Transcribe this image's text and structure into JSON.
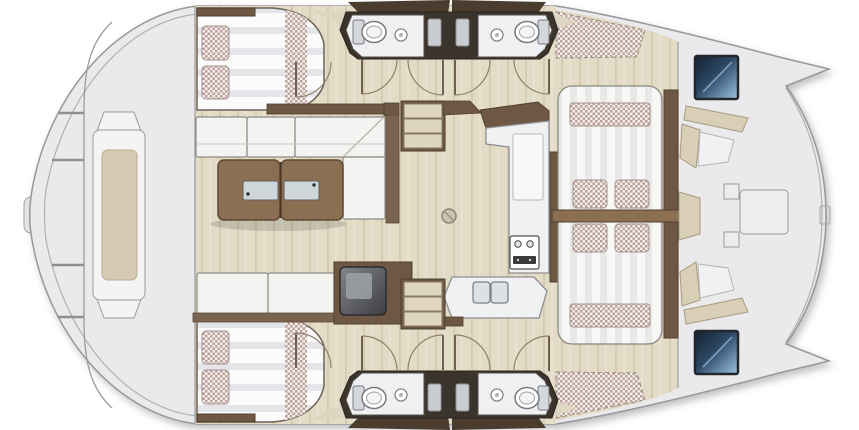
{
  "meta": {
    "title": "Catamaran deck and interior floor plan (top view)",
    "type": "boat-floor-plan",
    "orientation": "hulls top and bottom, lounge deck right, trampoline bow left"
  },
  "colors": {
    "canvas": "#ffffff",
    "hull": "#eaeaec",
    "hull_stroke": "#98989a",
    "floor_wood": "#e2dbc6",
    "cabinet_wood": "#6e5844",
    "table_wood": "#8a6f52",
    "joinery_dark": "#3b342c",
    "roof_wedge": "#4a3d30",
    "cushion_white": "#f3f3f1",
    "cushion_beige": "#d6cbb2",
    "deck_cushion": "#d9cfb6",
    "counter": "#f0f1f3",
    "metal": "#cfd6da",
    "appliance_frame": "#2c2c2e",
    "hatch_frame": "#23262b",
    "hatch_navy": "#2c4764",
    "mesh_accent": "#b2938f",
    "tray": "#c9ccd0"
  },
  "areas": [
    {
      "id": "bow-deck",
      "items": [
        "center-lounge-pod",
        "beige-cushion",
        "crossbars",
        "bow-step"
      ]
    },
    {
      "id": "upper-cabin",
      "items": [
        "double-berth",
        "two-checkered-pillows",
        "checkered-runner",
        "headboard-shelf"
      ]
    },
    {
      "id": "lower-cabin",
      "items": [
        "double-berth",
        "two-checkered-pillows",
        "checkered-runner",
        "headboard-shelf"
      ]
    },
    {
      "id": "upper-head",
      "items": [
        "toilet",
        "round-washbasin",
        "shower-column",
        "two-doors"
      ]
    },
    {
      "id": "lower-head",
      "items": [
        "toilet",
        "round-washbasin",
        "shower-column",
        "two-doors"
      ]
    },
    {
      "id": "salon",
      "items": [
        "l-shaped-sofa",
        "split-coffee-table",
        "bench-seat",
        "refrigerator-box"
      ]
    },
    {
      "id": "galley",
      "items": [
        "l-counter",
        "double-sink",
        "stove-panel",
        "round-floor-hatch"
      ]
    },
    {
      "id": "companionway",
      "items": [
        "upper-stairs-3-steps",
        "lower-stairs-3-steps"
      ]
    },
    {
      "id": "aft-lounge",
      "items": [
        "striped-sunpad",
        "four-checkered-pillows",
        "two-checkered-bolsters",
        "lounge-table-bar",
        "side-planks"
      ]
    },
    {
      "id": "stern-deck",
      "items": [
        "two-navy-hatches",
        "beige-bench-cushions",
        "center-platform",
        "net-panels"
      ]
    }
  ],
  "toilet_count": 4,
  "sink_count": 4,
  "berth_count": 2,
  "stair_steps_per_flight": 3
}
